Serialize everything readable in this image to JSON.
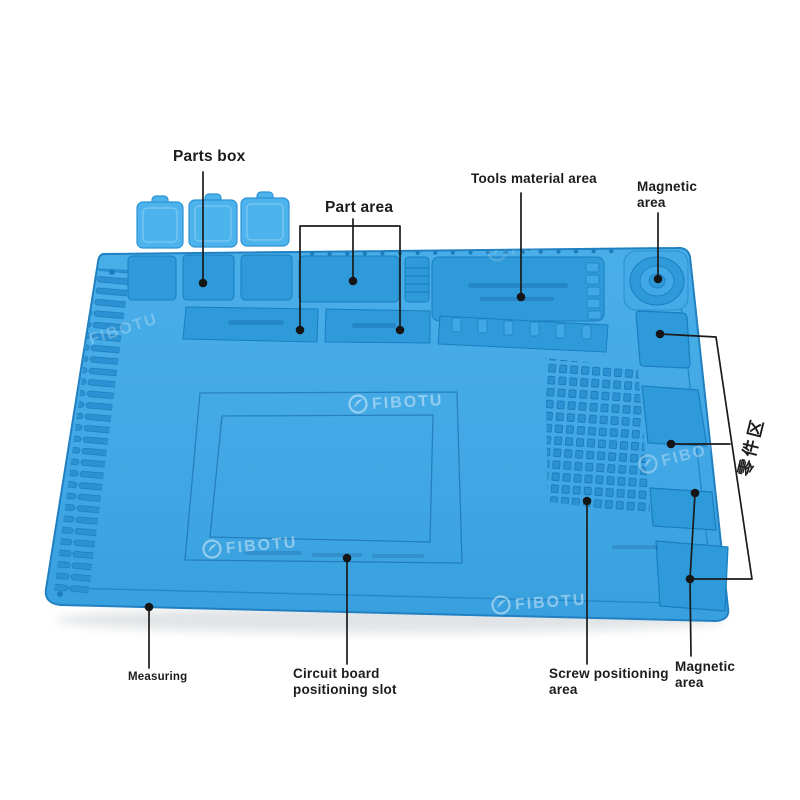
{
  "diagram_title": "Soldering repair mat feature callouts",
  "labels": {
    "parts_box": "Parts box",
    "part_area": "Part area",
    "tools_material_area": "Tools material area",
    "magnetic_area_top": "Magnetic area",
    "parts_area_cn": "零件区",
    "magnetic_area_bottom": "Magnetic area",
    "screw_positioning_area": "Screw positioning area",
    "circuit_board_positioning_slot": "Circuit board positioning slot",
    "measuring": "Measuring"
  },
  "watermark": {
    "brand": "FIBOTU"
  },
  "colors": {
    "background": "#ffffff",
    "mat_blue": "#3fa8e5",
    "mat_blue_light": "#52b3eb",
    "mat_recess": "#2f9ad9",
    "mat_groove_line": "#1a7ec0",
    "lid_blue": "#4db3ec",
    "callout_line": "#1b1b1b",
    "watermark_white": "rgba(255,255,255,0.42)"
  }
}
